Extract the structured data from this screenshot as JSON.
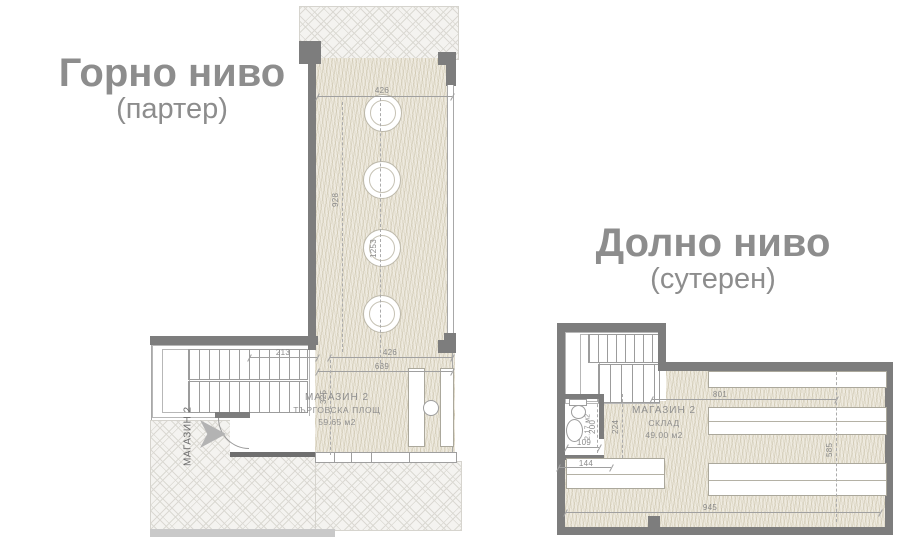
{
  "upper_plan": {
    "title": "Горно ниво",
    "subtitle": "(партер)",
    "room": {
      "name": "МАГАЗИН 2",
      "type": "ТЪРГОВСКА ПЛОЩ",
      "area": "59.65 м2"
    },
    "entrance_label": "МАГАЗИН 2",
    "dims": {
      "top_width": "426",
      "shaft_left": "928",
      "shaft_right": "1253",
      "stair_run": "213",
      "room_width": "426",
      "room_total": "639",
      "entry_depth": "325"
    }
  },
  "lower_plan": {
    "title": "Долно ниво",
    "subtitle": "(сутерен)",
    "room": {
      "name": "МАГАЗИН 2",
      "type": "СКЛАД",
      "area": "49.00 м2"
    },
    "wc_area": "2.17 м2",
    "dims": {
      "top_width": "801",
      "right_height": "585",
      "bottom_width": "945",
      "wc_width": "109",
      "wc_depth": "200",
      "corridor_depth": "224",
      "entry_width": "144"
    }
  },
  "colors": {
    "wall": "#7d7d7d",
    "dim_line": "#a0a0a0",
    "dim_text": "#8a8a8a",
    "title_text": "#8d8d8d",
    "hatch_bg": "#eeeade",
    "hatch_line": "#cfc7ae",
    "lattice_bg": "#f4f3f0",
    "lattice_line": "#dbd9d3",
    "arrow": "#b3b3b3"
  }
}
